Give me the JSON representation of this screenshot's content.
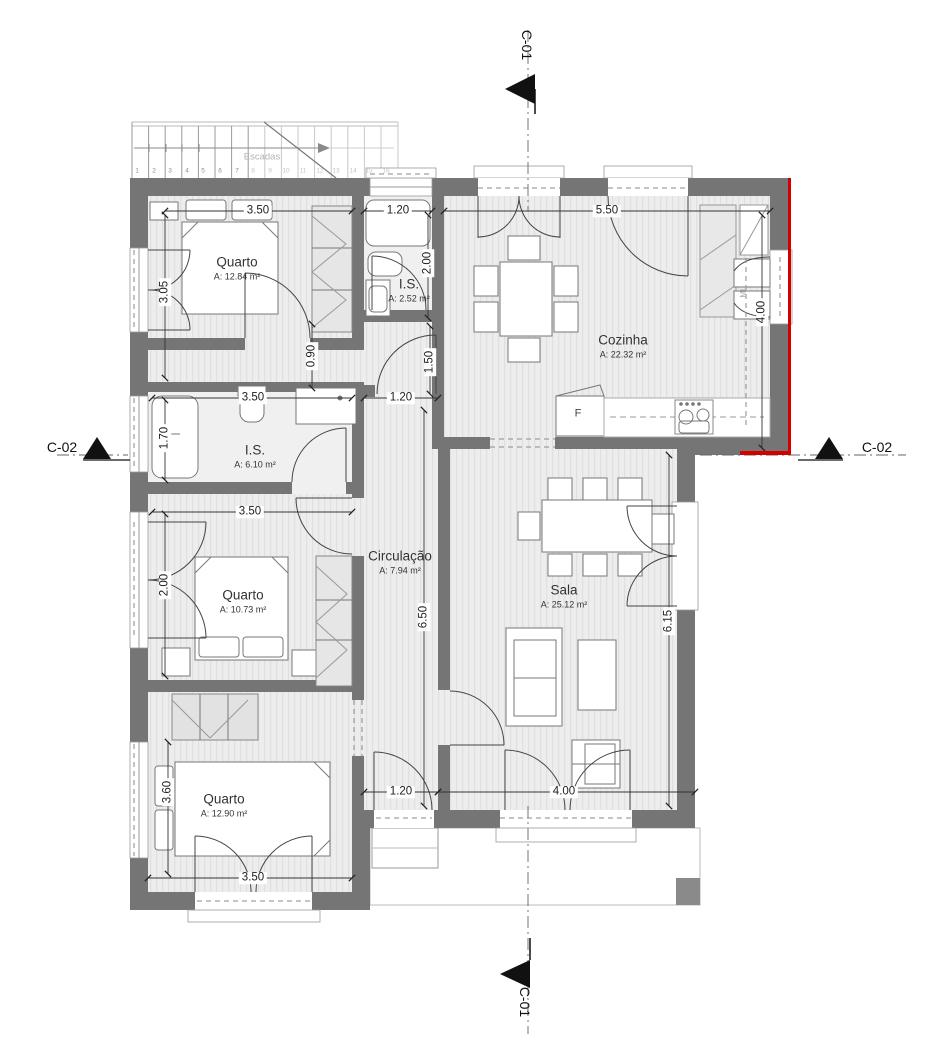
{
  "plan": {
    "section_markers": {
      "top": "C-01",
      "bottom": "C-01",
      "left": "C-02",
      "right": "C-02"
    },
    "stairs": {
      "label": "Escadas",
      "numbers": [
        "1",
        "2",
        "3",
        "4",
        "5",
        "6",
        "7",
        "8",
        "9",
        "10",
        "11",
        "12",
        "13",
        "14",
        "15",
        "16"
      ]
    },
    "rooms": {
      "quarto1": {
        "name": "Quarto",
        "area": "A: 12.84 m²"
      },
      "is1": {
        "name": "I.S.",
        "area": "A: 2.52 m²"
      },
      "cozinha": {
        "name": "Cozinha",
        "area": "A: 22.32 m²"
      },
      "is2": {
        "name": "I.S.",
        "area": "A: 6.10 m²"
      },
      "quarto2": {
        "name": "Quarto",
        "area": "A: 10.73 m²"
      },
      "circulacao": {
        "name": "Circulação",
        "area": "A: 7.94 m²"
      },
      "sala": {
        "name": "Sala",
        "area": "A: 25.12 m²"
      },
      "quarto3": {
        "name": "Quarto",
        "area": "A: 12.90 m²"
      }
    },
    "labels": {
      "fridge": "F",
      "cabinet": "ML"
    },
    "dimensions": {
      "quarto1_width": "3.50",
      "is1_width": "1.20",
      "cozinha_width": "5.50",
      "quarto1_height": "3.05",
      "is1_height": "2.00",
      "hall_gap": "0.90",
      "hall_opening": "1.50",
      "is2_width": "3.50",
      "hall_door": "1.20",
      "cozinha_height": "4.00",
      "is2_height": "1.70",
      "quarto2_width": "3.50",
      "quarto2_height": "2.00",
      "circulacao_height": "6.50",
      "sala_height": "6.15",
      "quarto3_height": "3.60",
      "exit_door": "1.20",
      "sala_width": "4.00",
      "quarto3_width": "3.50"
    },
    "colors": {
      "wall": "#757575",
      "floor": "#ededed",
      "accent_red": "#d40000",
      "line": "#333333"
    }
  }
}
